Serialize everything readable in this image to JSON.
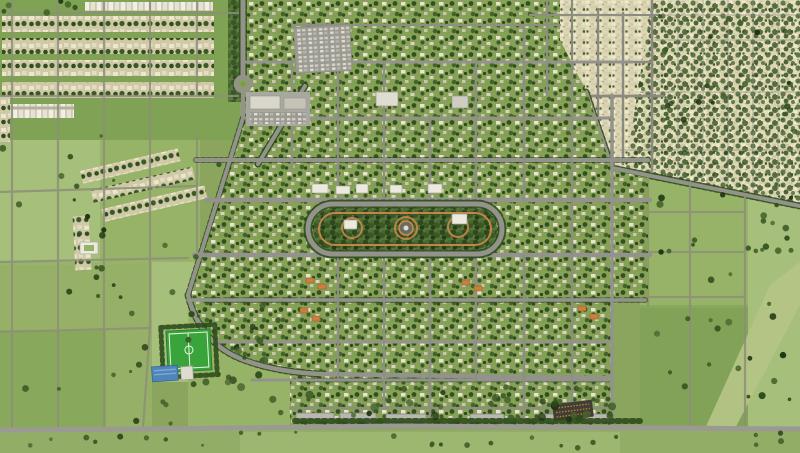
{
  "meta": {
    "view": "aerial-masterplan-render",
    "description": "Top-down aerial rendering of a planned green residential community with a central linear park, tree-lined streets, a sports pitch and pool at lower left, a commercial parking area near a northern roundabout, a dense older town grid at the top right, and surrounding farmland parcels with scattered trees."
  },
  "colors": {
    "fieldBase": "#8ba55e",
    "fieldLight": "#a6bf7a",
    "fieldLighter": "#b4c486",
    "fieldMid": "#97b368",
    "fieldDark": "#7da254",
    "fieldBottom": "#92ad66",
    "roadMain": "#93938c",
    "roadMinor": "#8d9080",
    "roadField": "#8d9078",
    "devBase": "#87a158",
    "treeDark": "#2e4c1c",
    "treeDeep": "#1f3512",
    "parkPath": "#d28a4c",
    "parkTreeBase": "#55733a",
    "oldTownBase": "#ddd6b4",
    "rowBase": "#cfc9a8",
    "houseLight": "#ece6ca",
    "plazaGray": "#a8a7a0",
    "roofWhite": "#eceadf",
    "roofGray": "#b9b8b0",
    "roofOrange": "#c9803f",
    "pitchGreen": "#3aa43c",
    "pitchLine": "#e8f4e0",
    "poolBlue": "#4f85bb",
    "poolBlueLight": "#7fa9d2",
    "marketDark": "#403f36"
  },
  "features": {
    "central_park": "Linear central park with ring road, orange paths and pavilions",
    "old_town": "Dense existing town grid at top right",
    "new_development": "Planned residential community with tree-lined streets",
    "sports_field": "Bright green sports pitch with white markings",
    "pool_complex": "Blue-roofed facility beside the pitch",
    "parking_lot": "Parking / commercial area near the north roundabout",
    "market_lot": "Dark stall rows near the south road",
    "farmland": "Agricultural parcels with scattered trees"
  }
}
